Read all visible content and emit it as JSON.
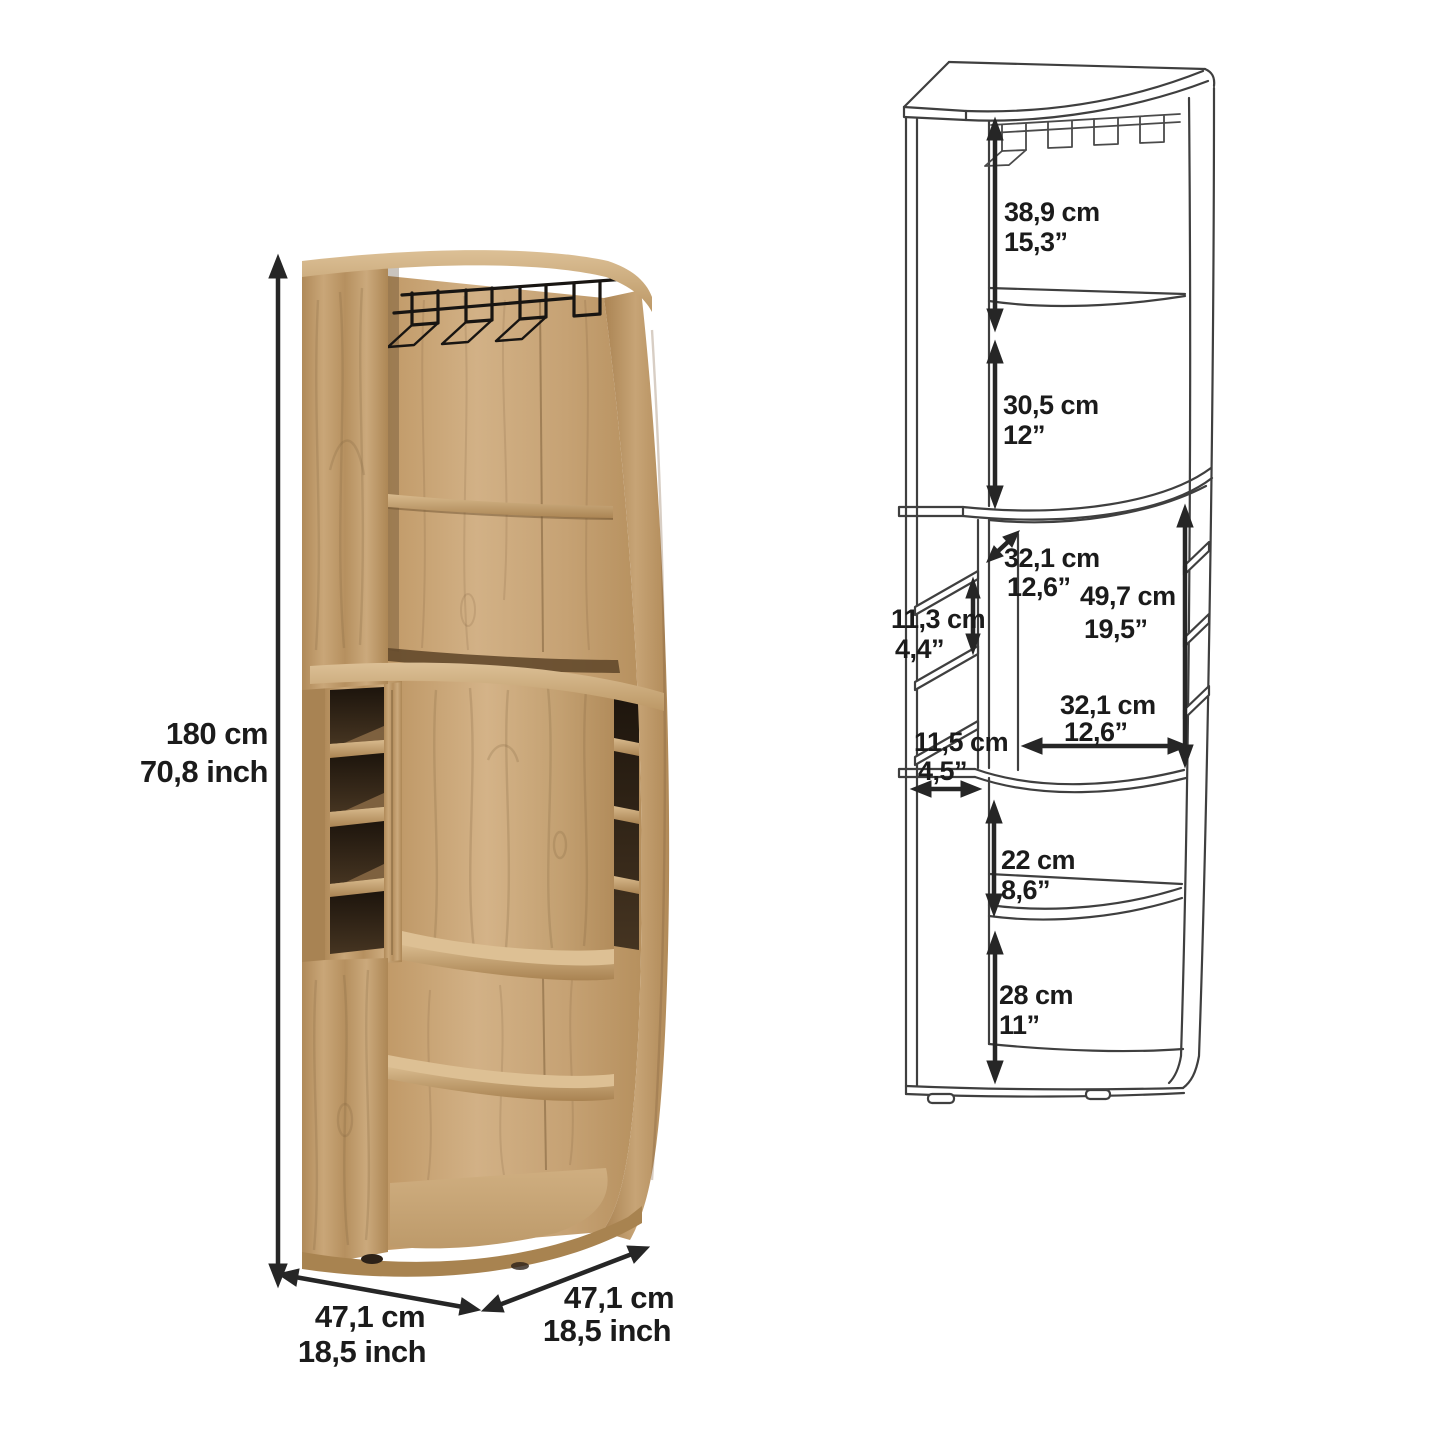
{
  "photo": {
    "height_cm": "180 cm",
    "height_inch": "70,8 inch",
    "depth_left_cm": "47,1 cm",
    "depth_left_inch": "18,5 inch",
    "depth_right_cm": "47,1 cm",
    "depth_right_inch": "18,5 inch"
  },
  "drawing": {
    "labels": {
      "rack_section": {
        "cm": "38,9 cm",
        "in": "15,3”"
      },
      "upper_shelf": {
        "cm": "30,5 cm",
        "in": "12”"
      },
      "depth_diag": {
        "cm": "32,1 cm",
        "in": "12,6”"
      },
      "cubby_height": {
        "cm": "11,3 cm",
        "in": "4,4”"
      },
      "middle_height": {
        "cm": "49,7 cm",
        "in": "19,5”"
      },
      "cubby_width": {
        "cm": "11,5 cm",
        "in": "4,5”"
      },
      "middle_width": {
        "cm": "32,1 cm",
        "in": "12,6”"
      },
      "lower_shelf": {
        "cm": "22 cm",
        "in": "8,6”"
      },
      "bottom_shelf": {
        "cm": "28 cm",
        "in": "11”"
      }
    }
  },
  "colors": {
    "background": "#ffffff",
    "wood_light": "#d9bc90",
    "wood_mid": "#c4a173",
    "wood_dark": "#96753f",
    "opening_dark": "#251b11",
    "line": "#3f3f3f",
    "dim": "#262626",
    "text": "#1b1b1b"
  }
}
